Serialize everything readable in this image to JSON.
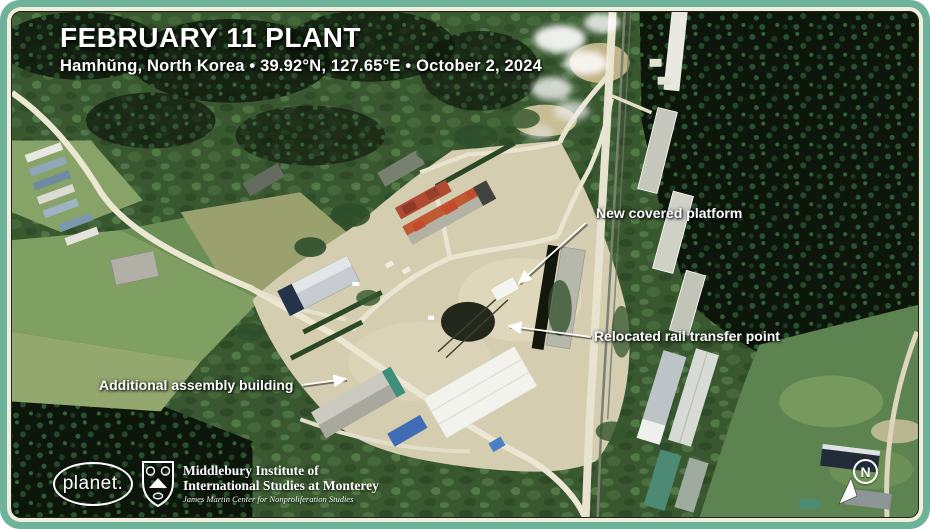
{
  "header": {
    "title": "FEBRUARY 11 PLANT",
    "subtitle": "Hamhŭng, North Korea • 39.92°N, 127.65°E • October 2, 2024"
  },
  "annotations": {
    "platform": "New covered platform",
    "rail": "Relocated rail transfer point",
    "assembly": "Additional assembly building"
  },
  "credits": {
    "planet": "planet.",
    "institute_line1": "Middlebury Institute of",
    "institute_line2": "International Studies at Monterey",
    "institute_line3": "James Martin Center for Nonproliferation Studies"
  },
  "compass": {
    "north": "N"
  },
  "colors": {
    "frame_teal": "#6FB29A",
    "frame_cream": "#F1EEDC",
    "annotation_text": "#FFFFFF",
    "red_roof": "#BF5A35",
    "blue_roof": "#3F6CB4"
  }
}
